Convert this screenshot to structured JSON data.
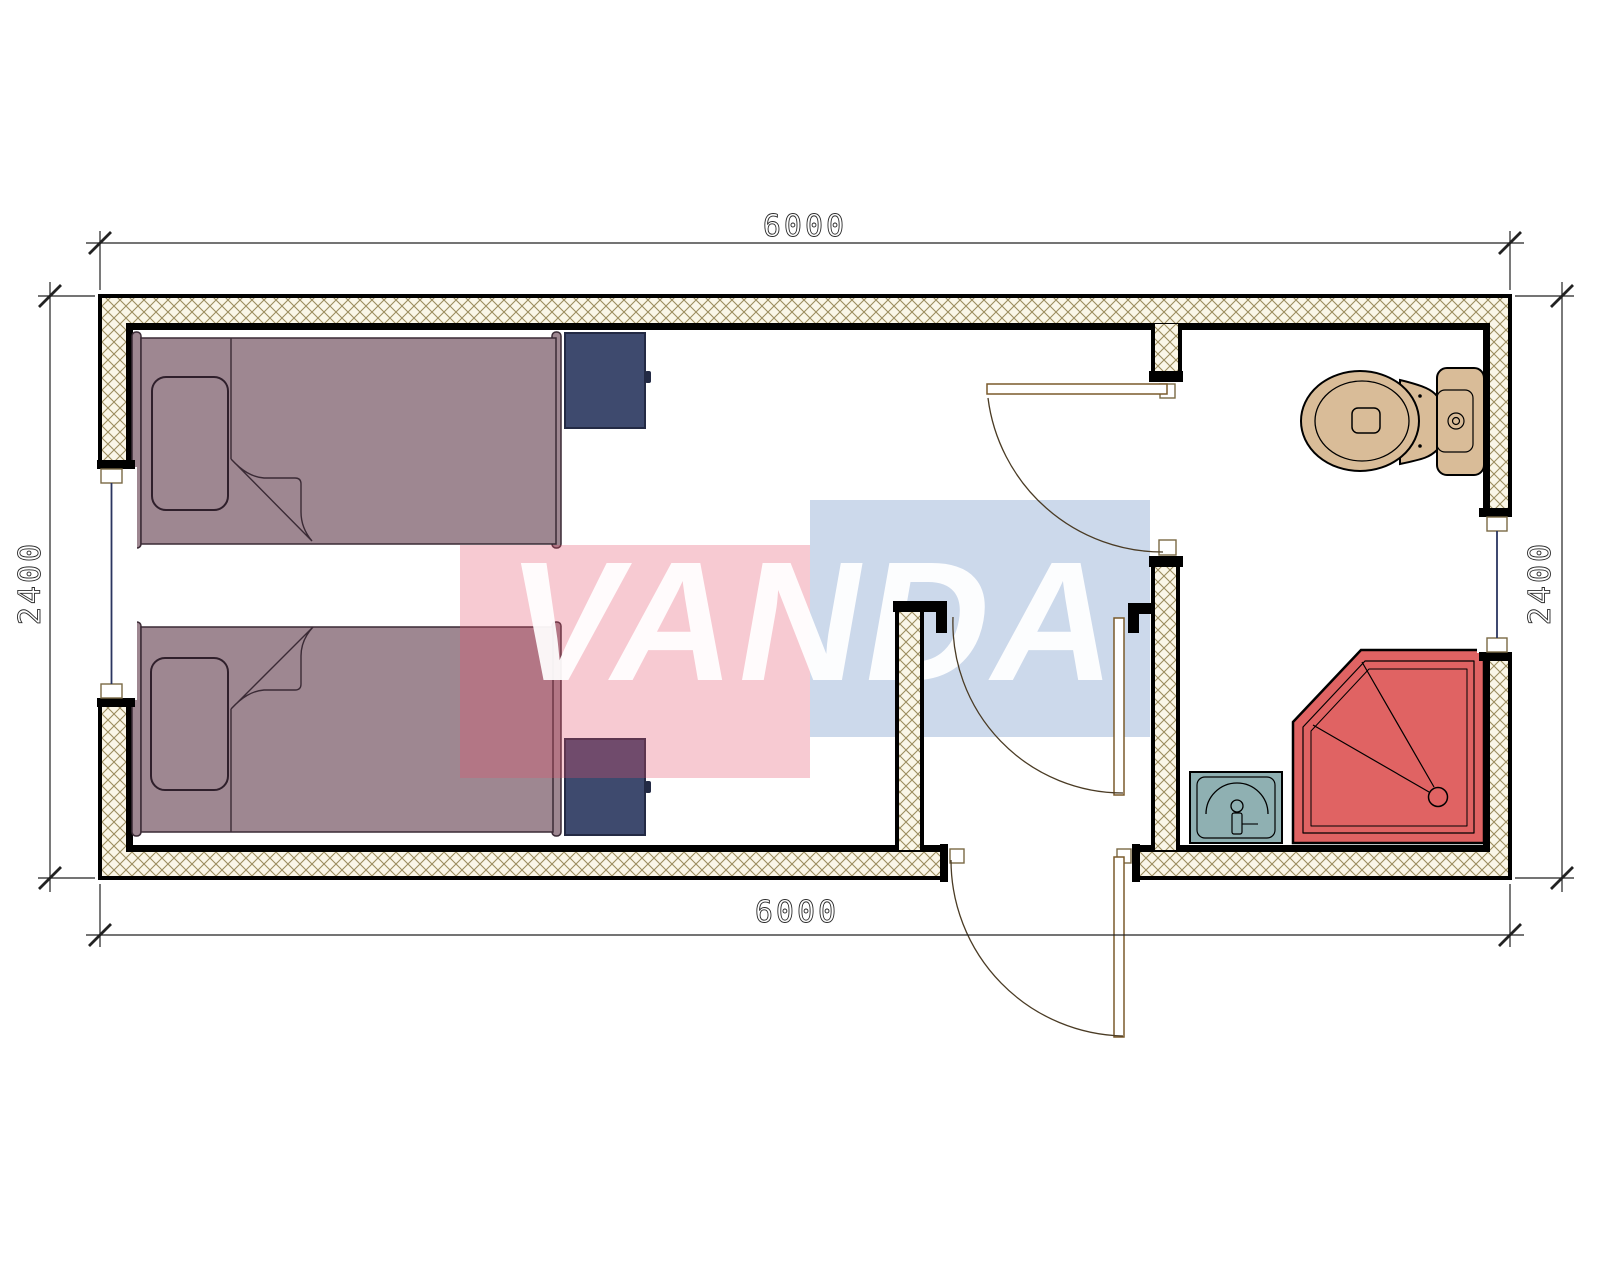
{
  "drawing": {
    "type": "floor-plan",
    "title": "modular cabin plan 6000x2400 with two single beds and bathroom",
    "dimensions": {
      "top": "6000",
      "bottom": "6000",
      "left": "2400",
      "right": "2400"
    },
    "watermark": {
      "text": "VANDA",
      "pink_rect_color": "rgba(230,80,105,0.30)",
      "blue_rect_color": "rgba(96,138,192,0.32)",
      "text_color": "rgba(255,255,255,0.93)"
    },
    "colors": {
      "wall_hatch_background": "#faf6e8",
      "wall_hatch_line": "#9b8c5f",
      "wall_outline": "#000000",
      "bed_fill": "#9e8791",
      "bed_outline": "#3a2a35",
      "nightstand_fill": "#3e4a6e",
      "nightstand_outline": "#232a44",
      "toilet_fill": "#d9bc98",
      "sink_fill": "#8fb0b2",
      "shower_fill": "#e06363",
      "window_glass_line": "#2a3560",
      "door_leaf_outline": "#7a5a2b",
      "door_swing_arc": "#4a3b24",
      "dimension_line": "#222222"
    }
  }
}
